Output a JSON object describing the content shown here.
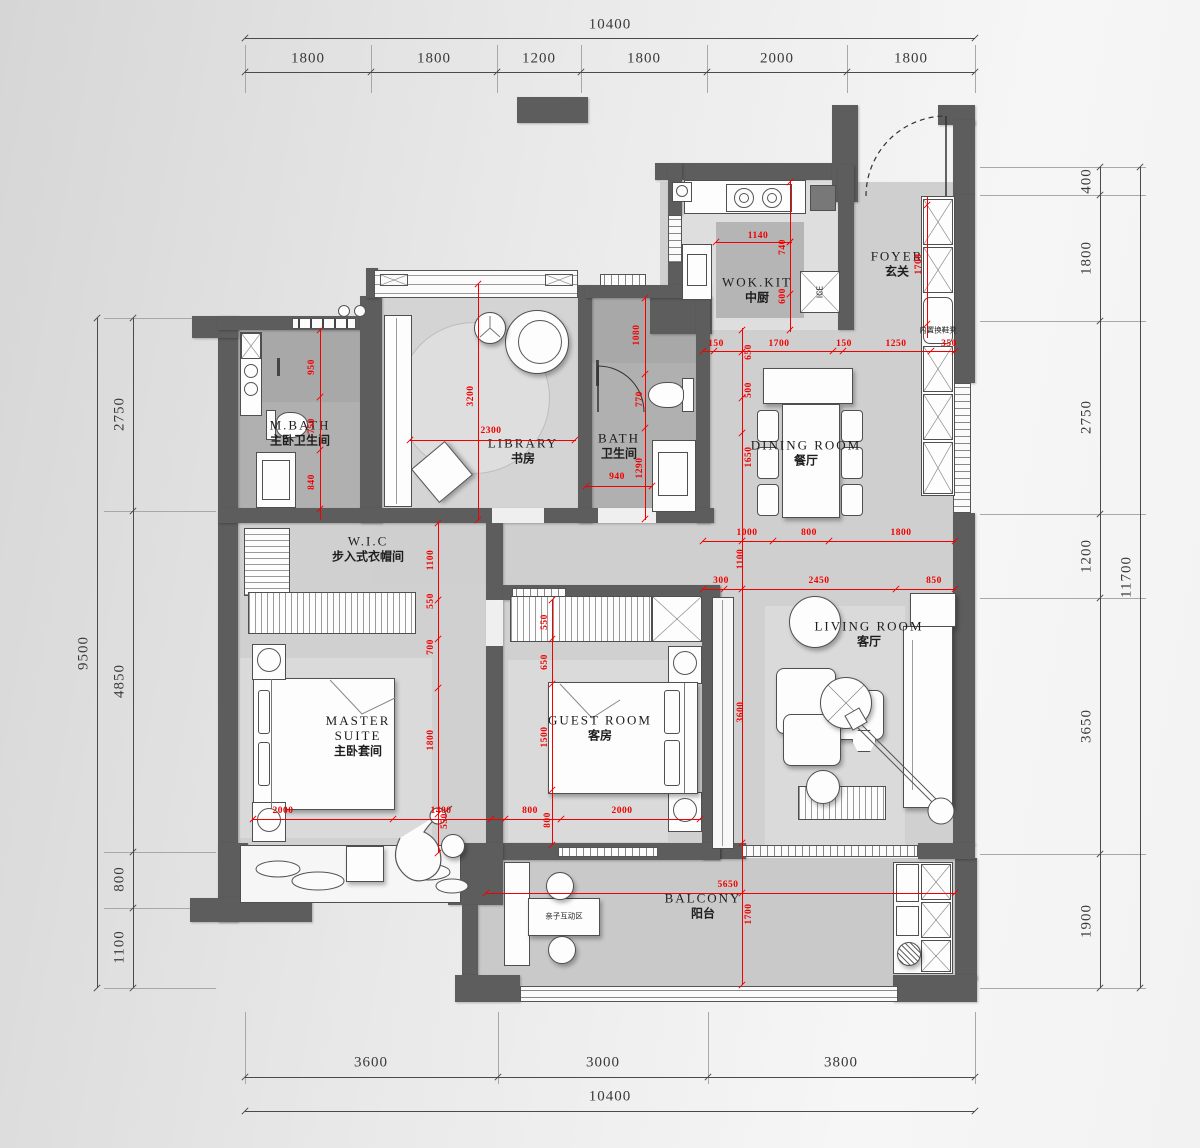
{
  "drawing": {
    "type": "residential floor plan",
    "units": "mm",
    "colors": {
      "wall": "#5d5d5d",
      "dim_red": "#f20000",
      "dim_black": "#3a3a3a",
      "floor_light": "#cfcfcf",
      "floor_dark": "#b0b0b0"
    }
  },
  "rooms": {
    "wok_kit": {
      "en": "WOK.KIT",
      "zh": "中厨",
      "x": 757,
      "y": 290
    },
    "foyer": {
      "en": "FOYER",
      "zh": "玄关",
      "x": 897,
      "y": 264
    },
    "dining": {
      "en": "DINING  ROOM",
      "zh": "餐厅",
      "x": 806,
      "y": 453
    },
    "library": {
      "en": "LIBRARY",
      "zh": "书房",
      "x": 523,
      "y": 451
    },
    "bath": {
      "en": "BATH",
      "zh": "卫生间",
      "x": 619,
      "y": 446
    },
    "mbath": {
      "en": "M.BATH",
      "zh": "主卧卫生间",
      "x": 300,
      "y": 433
    },
    "wic": {
      "en": "W.I.C",
      "zh": "步入式衣帽间",
      "x": 368,
      "y": 549
    },
    "master": {
      "en": "MASTER\nSUITE",
      "zh": "主卧套间",
      "x": 358,
      "y": 736
    },
    "guest": {
      "en": "GUEST  ROOM",
      "zh": "客房",
      "x": 600,
      "y": 728
    },
    "living": {
      "en": "LIVING  ROOM",
      "zh": "客厅",
      "x": 869,
      "y": 634
    },
    "balcony": {
      "en": "BALCONY",
      "zh": "阳台",
      "x": 703,
      "y": 906
    }
  },
  "annotations": [
    {
      "id": "ice-label",
      "t": "ICE",
      "x": 820,
      "y": 292,
      "rot": 1
    },
    {
      "id": "shoe-bench-label",
      "t": "内置换鞋凳",
      "x": 938,
      "y": 330,
      "rot": 0
    },
    {
      "id": "kids-zone-label",
      "t": "亲子互动区",
      "x": 564,
      "y": 916,
      "rot": 0
    }
  ],
  "red_dims": [
    {
      "t": "1140",
      "x": 758,
      "y": 236,
      "r": 0
    },
    {
      "t": "740",
      "x": 783,
      "y": 247,
      "r": 1
    },
    {
      "t": "600",
      "x": 783,
      "y": 296,
      "r": 1
    },
    {
      "t": "1700",
      "x": 919,
      "y": 264,
      "r": 1
    },
    {
      "t": "150",
      "x": 716,
      "y": 344,
      "r": 0
    },
    {
      "t": "650",
      "x": 749,
      "y": 352,
      "r": 1
    },
    {
      "t": "1700",
      "x": 779,
      "y": 344,
      "r": 0
    },
    {
      "t": "150",
      "x": 844,
      "y": 344,
      "r": 0
    },
    {
      "t": "1250",
      "x": 896,
      "y": 344,
      "r": 0
    },
    {
      "t": "350",
      "x": 949,
      "y": 344,
      "r": 0
    },
    {
      "t": "500",
      "x": 749,
      "y": 390,
      "r": 1
    },
    {
      "t": "1650",
      "x": 749,
      "y": 457,
      "r": 1
    },
    {
      "t": "1000",
      "x": 747,
      "y": 533,
      "r": 0
    },
    {
      "t": "800",
      "x": 809,
      "y": 533,
      "r": 0
    },
    {
      "t": "1800",
      "x": 901,
      "y": 533,
      "r": 0
    },
    {
      "t": "1100",
      "x": 741,
      "y": 559,
      "r": 1
    },
    {
      "t": "300",
      "x": 721,
      "y": 581,
      "r": 0
    },
    {
      "t": "2450",
      "x": 819,
      "y": 581,
      "r": 0
    },
    {
      "t": "850",
      "x": 934,
      "y": 581,
      "r": 0
    },
    {
      "t": "3600",
      "x": 741,
      "y": 712,
      "r": 1
    },
    {
      "t": "5650",
      "x": 728,
      "y": 885,
      "r": 0
    },
    {
      "t": "1700",
      "x": 749,
      "y": 914,
      "r": 1
    },
    {
      "t": "3200",
      "x": 471,
      "y": 396,
      "r": 1
    },
    {
      "t": "2300",
      "x": 491,
      "y": 431,
      "r": 0
    },
    {
      "t": "1080",
      "x": 637,
      "y": 335,
      "r": 1
    },
    {
      "t": "770",
      "x": 640,
      "y": 399,
      "r": 1
    },
    {
      "t": "1290",
      "x": 640,
      "y": 468,
      "r": 1
    },
    {
      "t": "940",
      "x": 617,
      "y": 477,
      "r": 0
    },
    {
      "t": "950",
      "x": 312,
      "y": 367,
      "r": 1
    },
    {
      "t": "750",
      "x": 312,
      "y": 426,
      "r": 1
    },
    {
      "t": "840",
      "x": 312,
      "y": 482,
      "r": 1
    },
    {
      "t": "1100",
      "x": 431,
      "y": 560,
      "r": 1
    },
    {
      "t": "550",
      "x": 431,
      "y": 601,
      "r": 1
    },
    {
      "t": "700",
      "x": 431,
      "y": 647,
      "r": 1
    },
    {
      "t": "1800",
      "x": 431,
      "y": 740,
      "r": 1
    },
    {
      "t": "550",
      "x": 445,
      "y": 821,
      "r": 1
    },
    {
      "t": "2000",
      "x": 283,
      "y": 811,
      "r": 0
    },
    {
      "t": "1400",
      "x": 441,
      "y": 811,
      "r": 0
    },
    {
      "t": "800",
      "x": 530,
      "y": 811,
      "r": 0
    },
    {
      "t": "800",
      "x": 548,
      "y": 820,
      "r": 1
    },
    {
      "t": "2000",
      "x": 622,
      "y": 811,
      "r": 0
    },
    {
      "t": "550",
      "x": 545,
      "y": 622,
      "r": 1
    },
    {
      "t": "650",
      "x": 545,
      "y": 662,
      "r": 1
    },
    {
      "t": "1500",
      "x": 545,
      "y": 737,
      "r": 1
    }
  ],
  "black_dims": [
    {
      "t": "10400",
      "x": 610,
      "y": 25,
      "r": 0
    },
    {
      "t": "1800",
      "x": 308,
      "y": 59,
      "r": 0
    },
    {
      "t": "1800",
      "x": 434,
      "y": 59,
      "r": 0
    },
    {
      "t": "1200",
      "x": 539,
      "y": 59,
      "r": 0
    },
    {
      "t": "1800",
      "x": 644,
      "y": 59,
      "r": 0
    },
    {
      "t": "2000",
      "x": 777,
      "y": 59,
      "r": 0
    },
    {
      "t": "1800",
      "x": 911,
      "y": 59,
      "r": 0
    },
    {
      "t": "3600",
      "x": 371,
      "y": 1063,
      "r": 0
    },
    {
      "t": "3000",
      "x": 603,
      "y": 1063,
      "r": 0
    },
    {
      "t": "3800",
      "x": 841,
      "y": 1063,
      "r": 0
    },
    {
      "t": "10400",
      "x": 610,
      "y": 1097,
      "r": 0
    },
    {
      "t": "9500",
      "x": 84,
      "y": 653,
      "r": 1
    },
    {
      "t": "2750",
      "x": 120,
      "y": 414,
      "r": 1
    },
    {
      "t": "4850",
      "x": 120,
      "y": 681,
      "r": 1
    },
    {
      "t": "800",
      "x": 120,
      "y": 879,
      "r": 1
    },
    {
      "t": "1100",
      "x": 120,
      "y": 947,
      "r": 1
    },
    {
      "t": "400",
      "x": 1087,
      "y": 181,
      "r": 1
    },
    {
      "t": "1800",
      "x": 1087,
      "y": 258,
      "r": 1
    },
    {
      "t": "2750",
      "x": 1087,
      "y": 417,
      "r": 1
    },
    {
      "t": "1200",
      "x": 1087,
      "y": 556,
      "r": 1
    },
    {
      "t": "3650",
      "x": 1087,
      "y": 726,
      "r": 1
    },
    {
      "t": "1900",
      "x": 1087,
      "y": 921,
      "r": 1
    },
    {
      "t": "11700",
      "x": 1127,
      "y": 577,
      "r": 1
    }
  ]
}
